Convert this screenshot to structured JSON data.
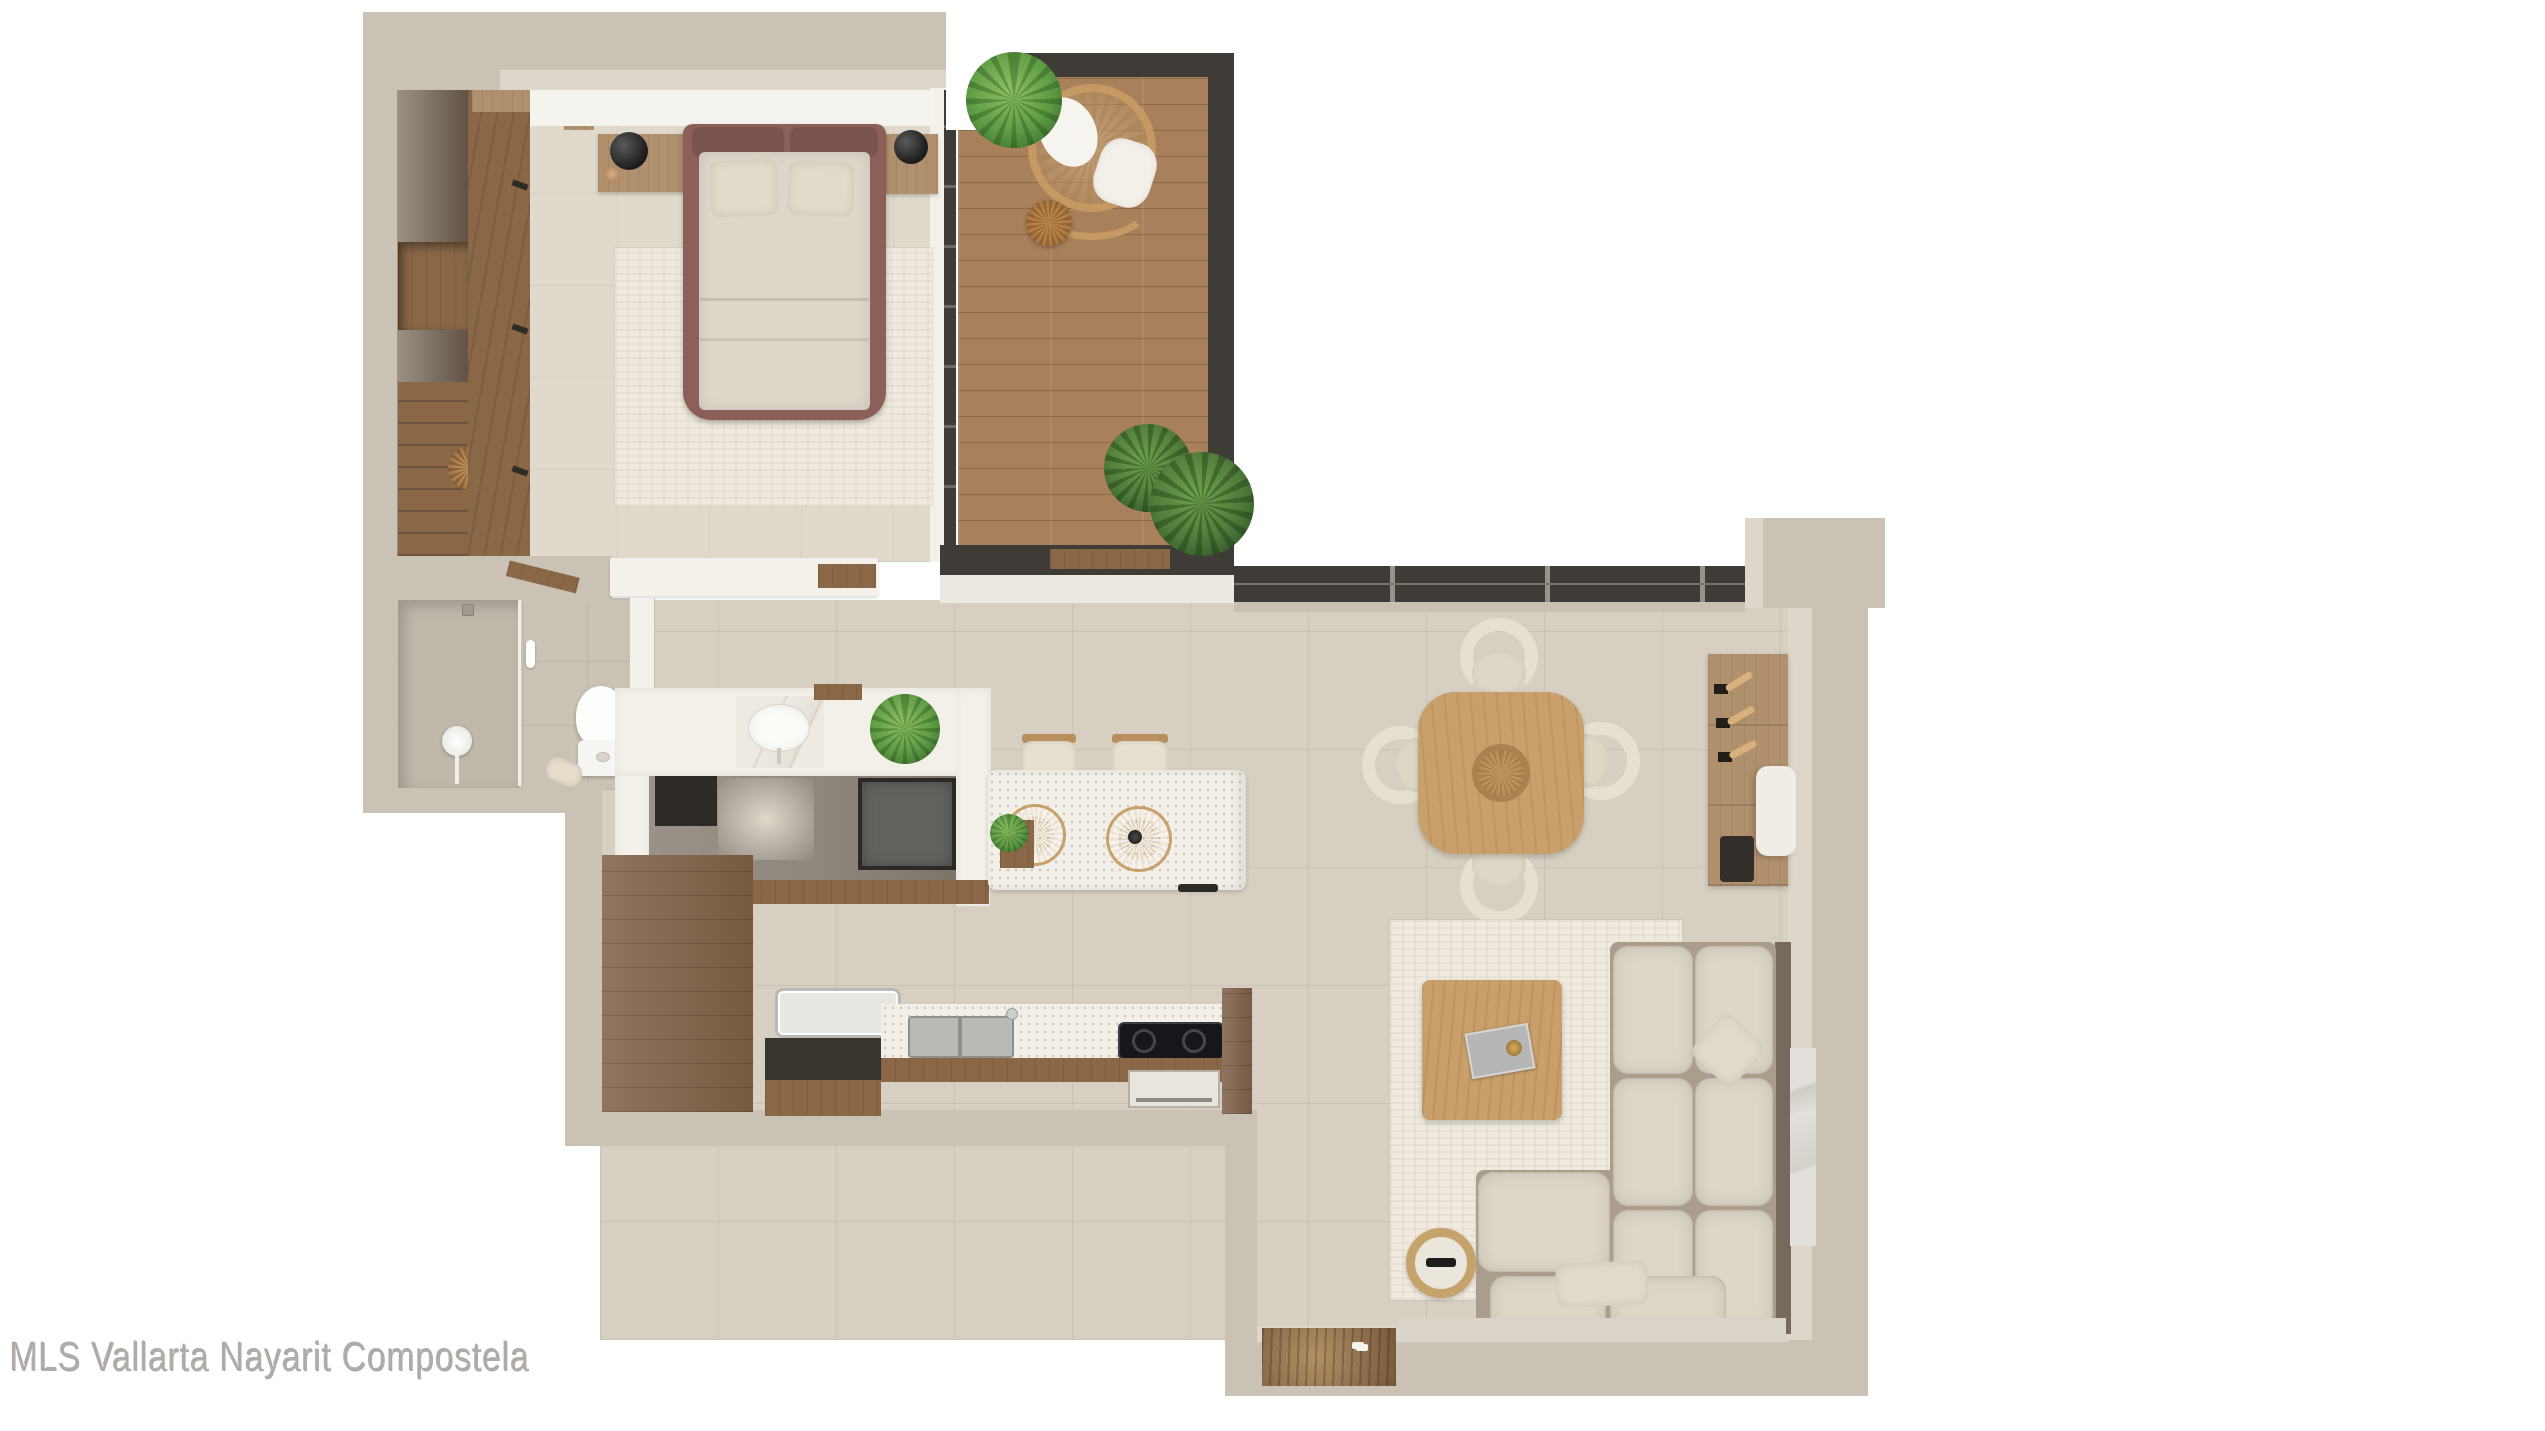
{
  "watermark": {
    "text": "MLS Vallarta Nayarit Compostela"
  },
  "palette": {
    "page_bg": "#ffffff",
    "wall": "#cbc2b6",
    "wall_inner": "#ddd6cb",
    "wall_white_cap": "#f4f1ea",
    "tile_floor": "#d6cfc2",
    "bedroom_floor": "#dfdacc",
    "bath_floor": "#c9c2b5",
    "balcony_wood": "#a8815c",
    "cabinet_wood": "#7d5f45",
    "shelf_wood": "#8a6847",
    "light_wood": "#c9a06b",
    "nightstand_wood": "#b1906d",
    "bed_frame": "#8c6058",
    "bedding": "#ddd7ca",
    "sofa": "#ded6c6",
    "rug": "#efeadd",
    "terrazzo": "#f2efe8",
    "window_frame": "#3f3b36",
    "plant_green": "#5d9b43",
    "appliance_dark": "#63625f",
    "steel": "#b9b9b6",
    "lamp_black": "#1b1b1b",
    "watermark_gray": "#b0aba6"
  }
}
